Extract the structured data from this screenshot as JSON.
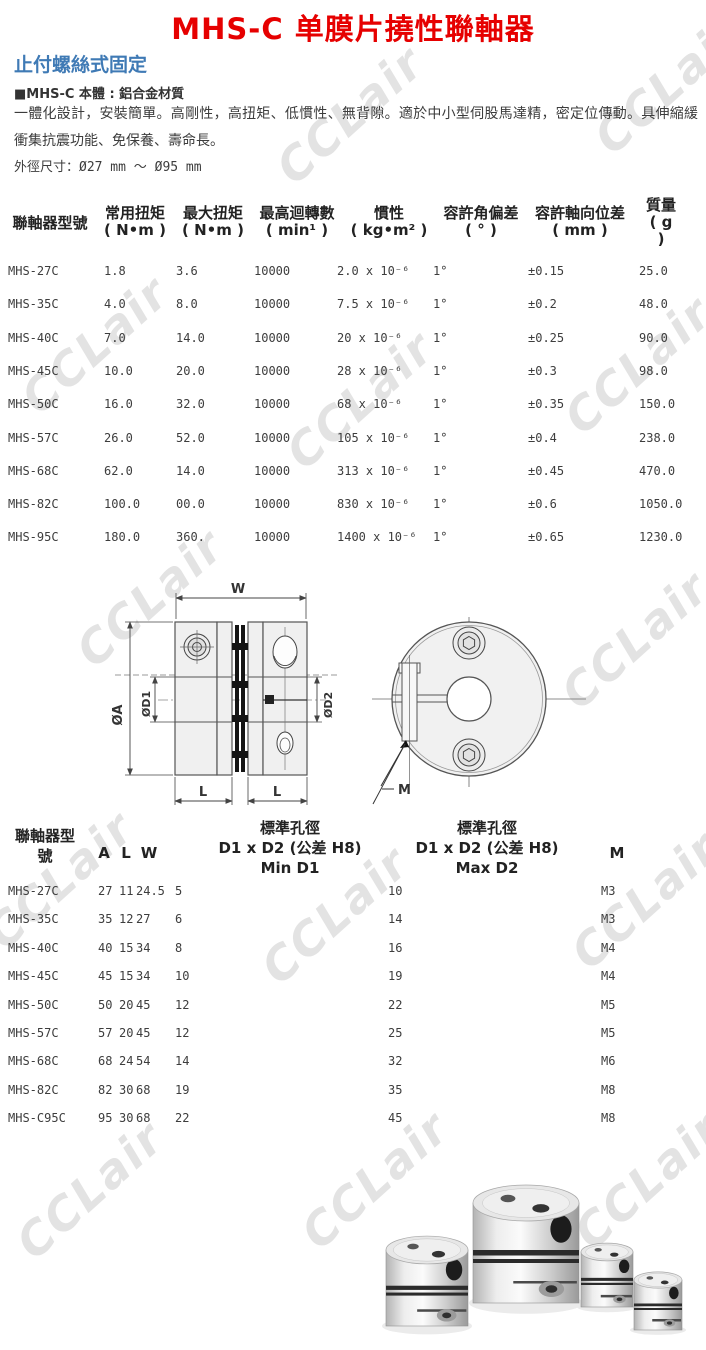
{
  "page": {
    "title": "MHS-C 单膜片撓性聯軸器",
    "subtitle": "止付螺絲式固定",
    "material_line": "■MHS-C 本體 : 鋁合金材質",
    "description": "一體化設計，安裝簡單。高剛性，高扭矩、低慣性、無背隙。適於中小型伺股馬達精，密定位傳動。具伸縮緩衝集抗震功能、免保養、壽命長。",
    "outer_dim": "外徑尺寸：Ø27 mm ～ Ø95 mm"
  },
  "watermark": {
    "text": "CCLair"
  },
  "colors": {
    "title_red": "#e60000",
    "subtitle_blue": "#3f7ab5",
    "watermark_gray": "#e3e3e3",
    "text_dark": "#3c3c3c"
  },
  "spec_table": {
    "columns": [
      {
        "label": "聯軸器型號"
      },
      {
        "label": "常用扭矩\n( N•m )"
      },
      {
        "label": "最大扭矩\n( N•m )"
      },
      {
        "label": "最高迴轉數\n( min¹ )"
      },
      {
        "label": "慣性\n( kg•m² )"
      },
      {
        "label": "容許角偏差\n( ° )"
      },
      {
        "label": "容許軸向位差\n( mm )"
      },
      {
        "label": "質量\n( g\n)"
      }
    ],
    "rows": [
      [
        "MHS-27C",
        "1.8",
        "3.6",
        "10000",
        "2.0 x 10⁻⁶",
        "1°",
        "±0.15",
        "25.0"
      ],
      [
        "MHS-35C",
        "4.0",
        "8.0",
        "10000",
        "7.5 x 10⁻⁶",
        "1°",
        "±0.2",
        "48.0"
      ],
      [
        "MHS-40C",
        "7.0",
        "14.0",
        "10000",
        "20 x 10⁻⁶",
        "1°",
        "±0.25",
        "90.0"
      ],
      [
        "MHS-45C",
        "10.0",
        "20.0",
        "10000",
        "28 x 10⁻⁶",
        "1°",
        "±0.3",
        "98.0"
      ],
      [
        "MHS-50C",
        "16.0",
        "32.0",
        "10000",
        "68 x 10⁻⁶",
        "1°",
        "±0.35",
        "150.0"
      ],
      [
        "MHS-57C",
        "26.0",
        "52.0",
        "10000",
        "105 x 10⁻⁶",
        "1°",
        "±0.4",
        "238.0"
      ],
      [
        "MHS-68C",
        "62.0",
        "14.0",
        "10000",
        "313 x 10⁻⁶",
        "1°",
        "±0.45",
        "470.0"
      ],
      [
        "MHS-82C",
        "100.0",
        "00.0",
        "10000",
        "830 x 10⁻⁶",
        "1°",
        "±0.6",
        "1050.0"
      ],
      [
        "MHS-95C",
        "180.0",
        "360.",
        "10000",
        "1400 x 10⁻⁶",
        "1°",
        "±0.65",
        "1230.0"
      ]
    ]
  },
  "dim_table": {
    "columns": [
      {
        "label": "聯軸器型\n號"
      },
      {
        "label": "A"
      },
      {
        "label": "L"
      },
      {
        "label": "W"
      },
      {
        "label": "標準孔徑\nD1 x D2 (公差 H8)\nMin D1"
      },
      {
        "label": "標準孔徑\nD1 x D2 (公差 H8)\nMax D2"
      },
      {
        "label": "M"
      }
    ],
    "rows": [
      [
        "MHS-27C",
        "27",
        "11",
        "24.5",
        "5",
        "10",
        "M3"
      ],
      [
        "MHS-35C",
        "35",
        "12",
        "27",
        "6",
        "14",
        "M3"
      ],
      [
        "MHS-40C",
        "40",
        "15",
        "34",
        "8",
        "16",
        "M4"
      ],
      [
        "MHS-45C",
        "45",
        "15",
        "34",
        "10",
        "19",
        "M4"
      ],
      [
        "MHS-50C",
        "50",
        "20",
        "45",
        "12",
        "22",
        "M5"
      ],
      [
        "MHS-57C",
        "57",
        "20",
        "45",
        "12",
        "25",
        "M5"
      ],
      [
        "MHS-68C",
        "68",
        "24",
        "54",
        "14",
        "32",
        "M6"
      ],
      [
        "MHS-82C",
        "82",
        "30",
        "68",
        "19",
        "35",
        "M8"
      ],
      [
        "MHS-C95C",
        "95",
        "30",
        "68",
        "22",
        "45",
        "M8"
      ]
    ]
  },
  "drawing": {
    "labels": {
      "width": "W",
      "outer_dia": "ØA",
      "bore1": "ØD1",
      "bore2": "ØD2",
      "hub_len_left": "L",
      "hub_len_right": "L",
      "screw": "M"
    }
  }
}
